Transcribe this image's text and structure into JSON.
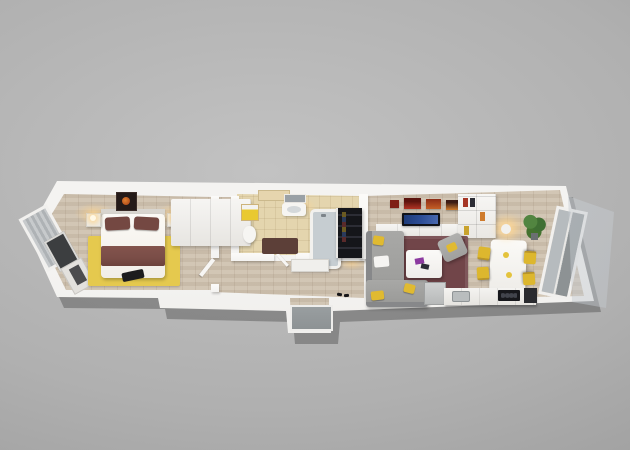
{
  "scene": {
    "type": "3d-floorplan-render",
    "rooms": [
      "bedroom",
      "wardrobe",
      "bathroom",
      "hallway",
      "entrance",
      "living-room",
      "dining-area",
      "kitchen",
      "balcony"
    ]
  },
  "palette": {
    "bg_center": "#c2c2c2",
    "bg_edge": "#999999",
    "wall": "#f4f3f1",
    "wood": "#cfc2b0",
    "tile": "#e4d5ae",
    "rug_bedroom": "#e5c94e",
    "duvet": "#f1eee8",
    "maroon": "#744842",
    "blanket": "#7a4d47",
    "rug_living": "#714549",
    "sofa": "#9b9b99",
    "cushion": "#e0ba31",
    "chair_yellow": "#ddb72e",
    "yellow_box": "#e9c931",
    "dark_unit": "#1b1c21",
    "tv_screen": "#2c4d96",
    "art_red": "#b23524",
    "art_orange": "#cf7b2c",
    "plant": "#44722f",
    "door_gray": "#8d9294",
    "mat_brown": "#5c3f38",
    "mirror": "#9aa1a6",
    "glass": "rgba(190,196,202,0.45)",
    "glow": "rgba(255,211,140,0.6)"
  }
}
